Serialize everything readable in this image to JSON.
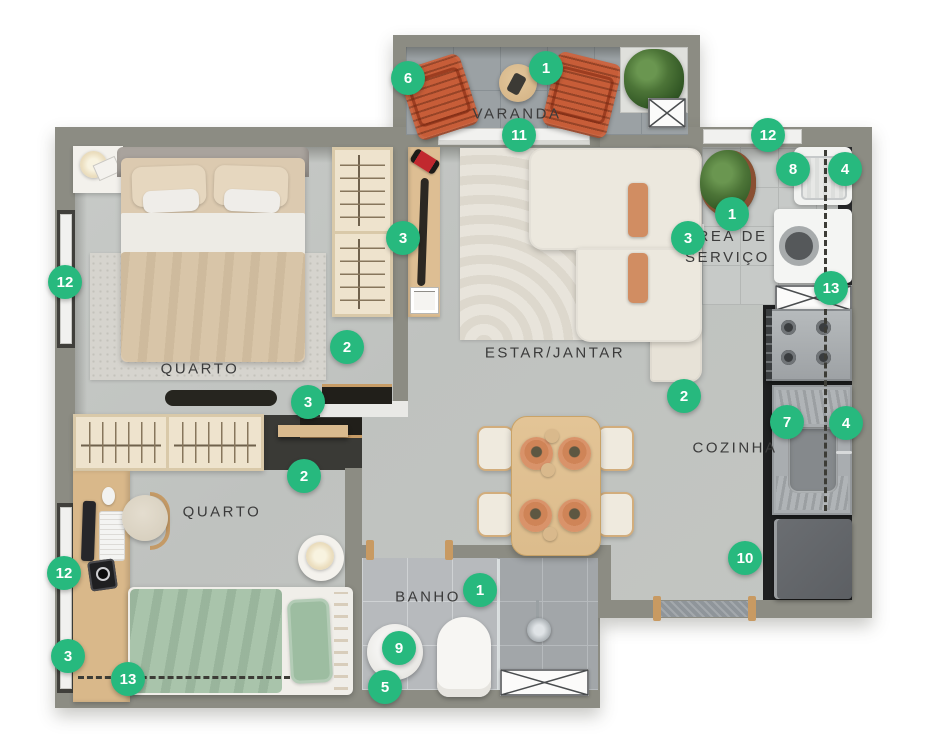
{
  "canvas": {
    "width": 926,
    "height": 737,
    "background": "#ffffff"
  },
  "colors": {
    "marker": "#27b97e",
    "wall": "#8c8c83",
    "floor_concrete": "#c2c5c2",
    "tile_varanda": "#9ba1a4",
    "wood": "#d9ba8e",
    "terracotta_chair": "#c75d38",
    "terracotta_cushion": "#d18d62",
    "sofa_cream": "#ece8de",
    "bed_beige": "#d8c5a8",
    "bed_green": "#a9c4ab",
    "label_text": "#3b3b3b"
  },
  "rooms": [
    {
      "id": "varanda",
      "label": "VARANDA",
      "x": 517,
      "y": 114
    },
    {
      "id": "quarto1",
      "label": "QUARTO",
      "x": 200,
      "y": 369
    },
    {
      "id": "estar",
      "label": "ESTAR/JANTAR",
      "x": 555,
      "y": 353
    },
    {
      "id": "servico",
      "label": "ÁREA DE SERVIÇO",
      "x": 737,
      "y": 247
    },
    {
      "id": "cozinha",
      "label": "COZINHA",
      "x": 735,
      "y": 448
    },
    {
      "id": "quarto2",
      "label": "QUARTO",
      "x": 222,
      "y": 512
    },
    {
      "id": "banho",
      "label": "BANHO",
      "x": 428,
      "y": 597
    }
  ],
  "markers": [
    {
      "n": "6",
      "x": 408,
      "y": 78
    },
    {
      "n": "1",
      "x": 546,
      "y": 68
    },
    {
      "n": "11",
      "x": 519,
      "y": 135
    },
    {
      "n": "12",
      "x": 65,
      "y": 282
    },
    {
      "n": "3",
      "x": 403,
      "y": 238
    },
    {
      "n": "2",
      "x": 347,
      "y": 347
    },
    {
      "n": "3",
      "x": 308,
      "y": 402
    },
    {
      "n": "3",
      "x": 688,
      "y": 238
    },
    {
      "n": "12",
      "x": 768,
      "y": 135
    },
    {
      "n": "8",
      "x": 793,
      "y": 169
    },
    {
      "n": "4",
      "x": 845,
      "y": 169
    },
    {
      "n": "1",
      "x": 732,
      "y": 214
    },
    {
      "n": "13",
      "x": 831,
      "y": 288
    },
    {
      "n": "2",
      "x": 684,
      "y": 396
    },
    {
      "n": "7",
      "x": 787,
      "y": 422
    },
    {
      "n": "4",
      "x": 846,
      "y": 423
    },
    {
      "n": "10",
      "x": 745,
      "y": 558
    },
    {
      "n": "2",
      "x": 304,
      "y": 476
    },
    {
      "n": "12",
      "x": 64,
      "y": 573
    },
    {
      "n": "3",
      "x": 68,
      "y": 656
    },
    {
      "n": "13",
      "x": 128,
      "y": 679
    },
    {
      "n": "1",
      "x": 480,
      "y": 590
    },
    {
      "n": "9",
      "x": 399,
      "y": 648
    },
    {
      "n": "5",
      "x": 385,
      "y": 687
    }
  ]
}
